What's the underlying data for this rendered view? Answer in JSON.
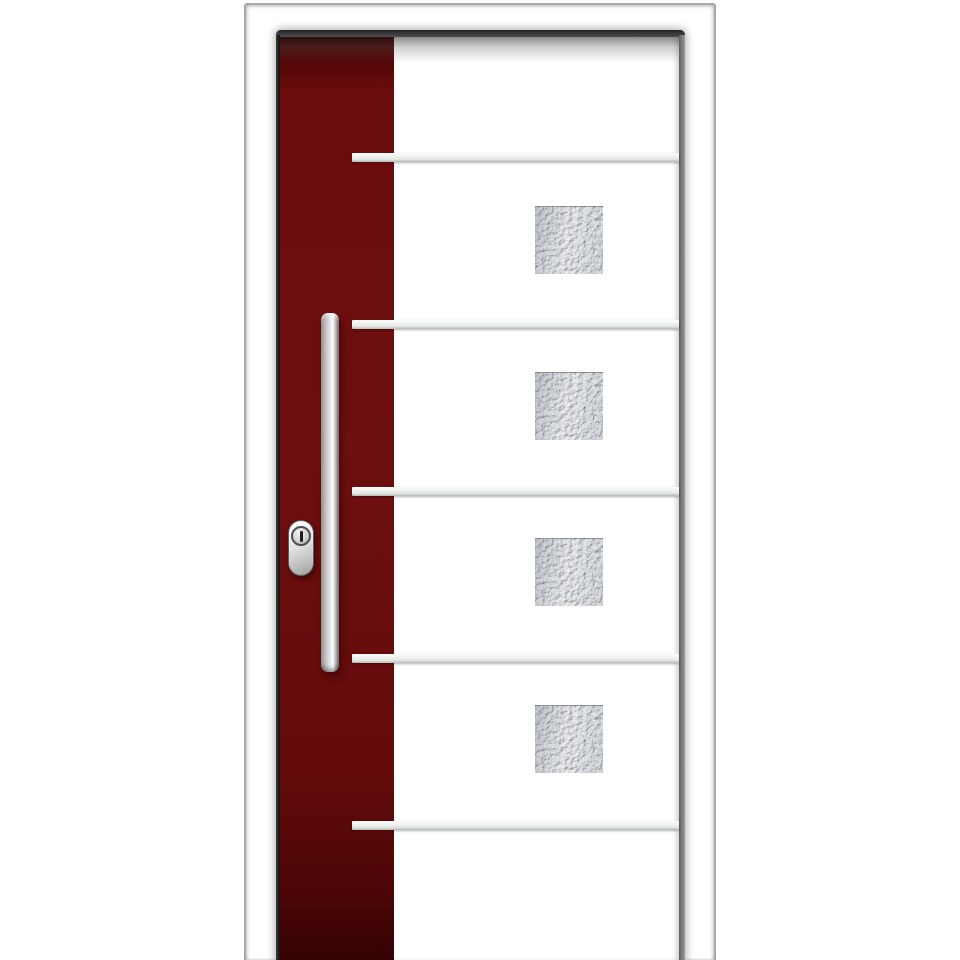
{
  "scene": {
    "type": "product-photo",
    "subject": "Modern aluminium front entry door with white leaf and dark red accent stripe",
    "background_color": "#ffffff"
  },
  "door": {
    "frame": {
      "color": "#ffffff",
      "outline_color": "#a8a8a8"
    },
    "leaf": {
      "main_panel_color": "#ffffff",
      "accent_panel": {
        "position": "left",
        "color": "#6e0f0f"
      }
    },
    "aluminum_strips": {
      "count": 5,
      "orientation": "horizontal",
      "color": "#eef1ee"
    },
    "glass_panels": {
      "count": 4,
      "shape": "square",
      "glazing": "frosted hammered glass",
      "tint": "#d9dde0"
    },
    "handle": {
      "style": "vertical stainless-steel bar pull",
      "color": "#d7d7d7"
    },
    "lock": {
      "style": "oval cylinder escutcheon",
      "color": "#e2e2e2",
      "keyhole_color": "#1e1e1e"
    }
  }
}
